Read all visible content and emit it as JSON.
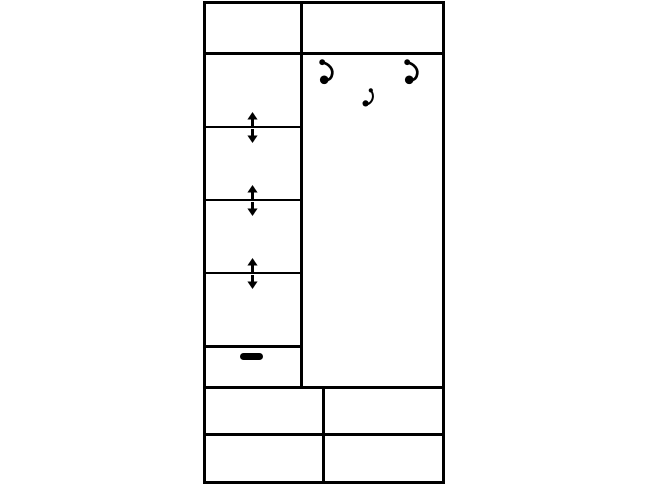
{
  "canvas": {
    "width": 648,
    "height": 486,
    "background": "#ffffff"
  },
  "colors": {
    "line": "#000000",
    "background": "#ffffff"
  },
  "diagram": {
    "kind": "furniture-front-elevation-line-drawing",
    "frame": {
      "name": "wardrobe-outline",
      "x": 203,
      "y": 1,
      "w": 242,
      "h": 483,
      "stroke": 3
    },
    "lines": [
      {
        "name": "top-cabinet-bottom-divider",
        "x": 203,
        "y": 52,
        "w": 242,
        "h": 3
      },
      {
        "name": "center-vertical-divider",
        "x": 300,
        "y": 1,
        "w": 3,
        "h": 388
      },
      {
        "name": "adjustable-shelf-line-1",
        "x": 206,
        "y": 126,
        "w": 94,
        "h": 2
      },
      {
        "name": "adjustable-shelf-line-2",
        "x": 206,
        "y": 199,
        "w": 94,
        "h": 2
      },
      {
        "name": "adjustable-shelf-line-3",
        "x": 206,
        "y": 272,
        "w": 94,
        "h": 2
      },
      {
        "name": "small-drawer-top-divider",
        "x": 206,
        "y": 345,
        "w": 94,
        "h": 3
      },
      {
        "name": "drawer-section-top-divider",
        "x": 203,
        "y": 386,
        "w": 242,
        "h": 3
      },
      {
        "name": "drawer-row-divider",
        "x": 203,
        "y": 433,
        "w": 242,
        "h": 3
      },
      {
        "name": "drawer-column-divider",
        "x": 322,
        "y": 386,
        "w": 3,
        "h": 95
      }
    ],
    "regions": [
      {
        "name": "top-cabinet-left-cell",
        "x": 206,
        "y": 4,
        "w": 94,
        "h": 48
      },
      {
        "name": "top-cabinet-right-cell",
        "x": 303,
        "y": 4,
        "w": 139,
        "h": 48
      },
      {
        "name": "shelf-compartment-1",
        "x": 206,
        "y": 55,
        "w": 94,
        "h": 71
      },
      {
        "name": "shelf-compartment-2",
        "x": 206,
        "y": 128,
        "w": 94,
        "h": 71
      },
      {
        "name": "shelf-compartment-3",
        "x": 206,
        "y": 201,
        "w": 94,
        "h": 71
      },
      {
        "name": "shelf-compartment-4",
        "x": 206,
        "y": 274,
        "w": 94,
        "h": 71
      },
      {
        "name": "small-drawer-front",
        "x": 206,
        "y": 348,
        "w": 94,
        "h": 38
      },
      {
        "name": "hanging-compartment",
        "x": 303,
        "y": 55,
        "w": 139,
        "h": 331
      },
      {
        "name": "drawer-top-left",
        "x": 206,
        "y": 389,
        "w": 116,
        "h": 44
      },
      {
        "name": "drawer-top-right",
        "x": 325,
        "y": 389,
        "w": 117,
        "h": 44
      },
      {
        "name": "drawer-bottom-left",
        "x": 206,
        "y": 436,
        "w": 116,
        "h": 45
      },
      {
        "name": "drawer-bottom-right",
        "x": 325,
        "y": 436,
        "w": 117,
        "h": 45
      }
    ],
    "shelf_adjust_arrows": {
      "center_x": 252,
      "arrow_w": 11,
      "arrow_h": 14,
      "line_ys": [
        126,
        199,
        272
      ],
      "gap_below_line": 3
    },
    "coat_hooks": [
      {
        "name": "coat-hook-left",
        "x": 317,
        "y": 59,
        "w": 22,
        "h": 26,
        "variant": "large"
      },
      {
        "name": "coat-hook-right",
        "x": 402,
        "y": 59,
        "w": 22,
        "h": 26,
        "variant": "large"
      },
      {
        "name": "coat-hook-center-small",
        "x": 360,
        "y": 88,
        "w": 16,
        "h": 20,
        "variant": "small"
      }
    ],
    "drawer_handle": {
      "name": "drawer-handle",
      "x": 240,
      "y": 353,
      "w": 23,
      "h": 7
    }
  }
}
